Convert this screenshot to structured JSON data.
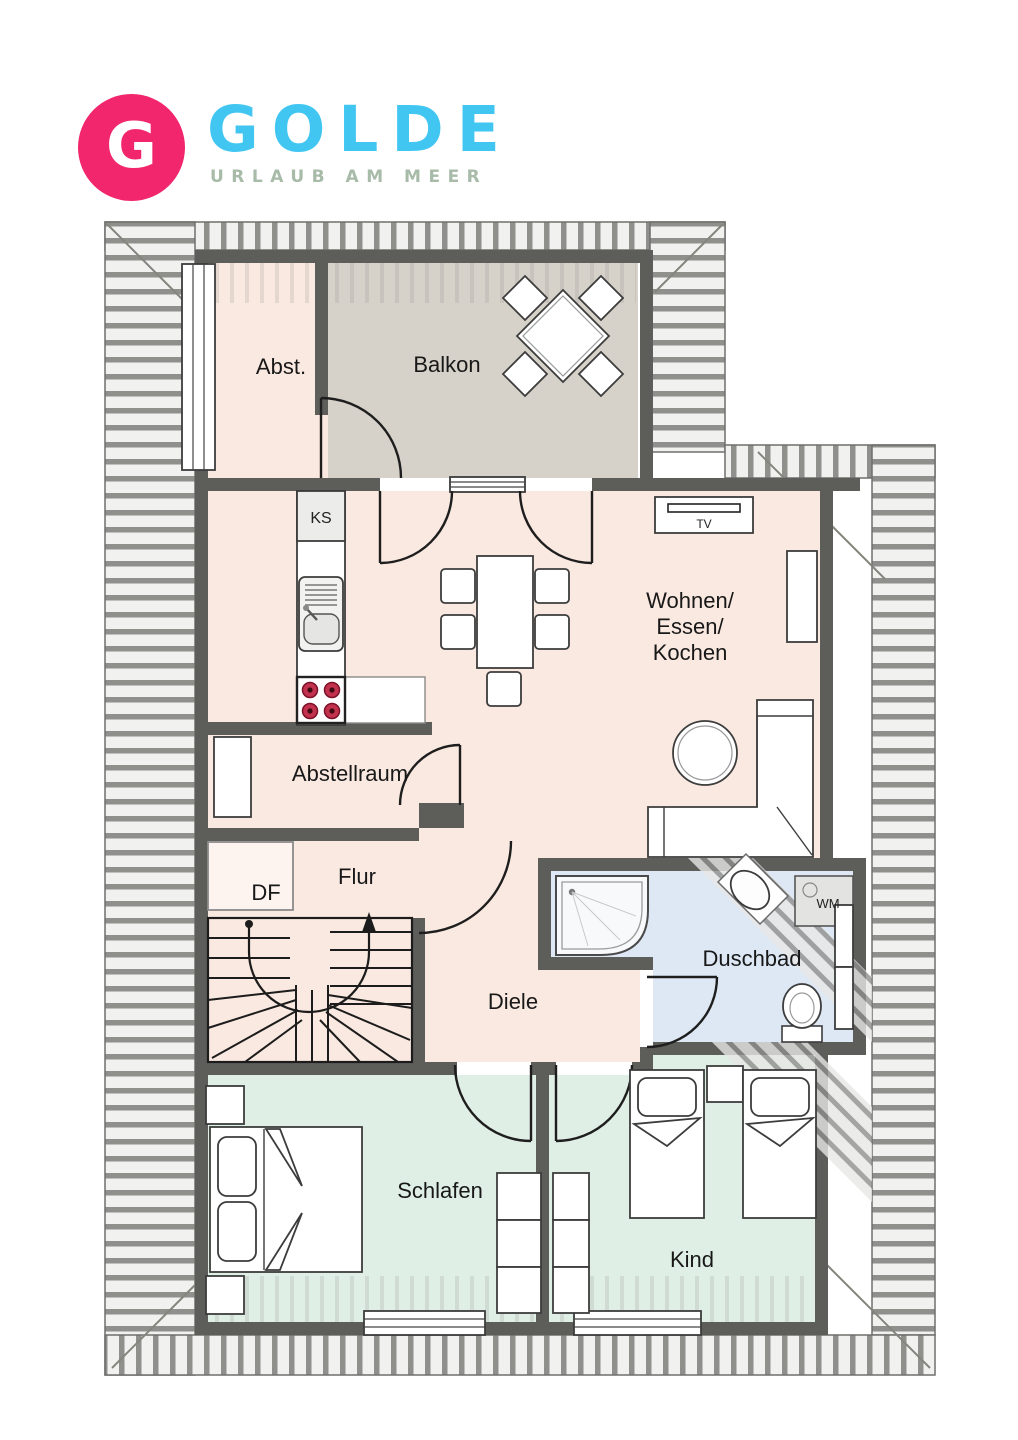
{
  "logo": {
    "monogram": "G",
    "name": "GOLDE",
    "tagline": "URLAUB AM MEER"
  },
  "rooms": {
    "abst": "Abst.",
    "balkon": "Balkon",
    "wohnen1": "Wohnen/",
    "wohnen2": "Essen/",
    "wohnen3": "Kochen",
    "abstellraum": "Abstellraum",
    "flur": "Flur",
    "diele": "Diele",
    "duschbad": "Duschbad",
    "schlafen": "Schlafen",
    "kind": "Kind"
  },
  "fixtures": {
    "ks": "KS",
    "tv": "TV",
    "wm": "WM",
    "df": "DF"
  },
  "colors": {
    "logo_circle": "#f1266c",
    "logo_name": "#41c6f2",
    "logo_tagline": "#a8bba9",
    "wall": "#5d5d5a",
    "floor_living": "#fae9e0",
    "floor_balcony": "#d6d2c9",
    "floor_bath": "#dde8f4",
    "floor_bedroom": "#e0efe5",
    "hatch_stripe": "#8f8f8c",
    "hatch_bg": "#f1f1ef",
    "stove_burner": "#c2314d"
  }
}
